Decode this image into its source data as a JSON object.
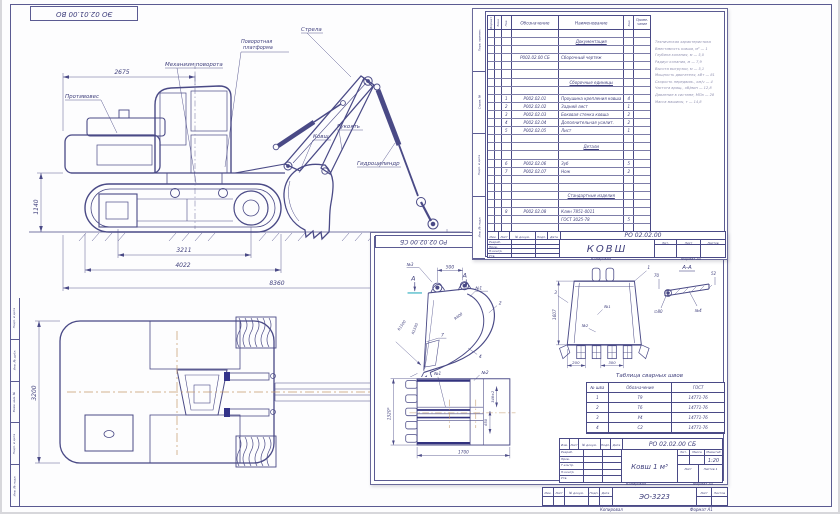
{
  "sheet": {
    "stamp_top": "ЭО 02.01.00 ВО",
    "model": "ЭО-3223",
    "footer_copy": "Копировал",
    "footer_format": "Формат А1",
    "cols": [
      "Изм.",
      "Лист",
      "№ докум.",
      "Подп.",
      "Дата"
    ],
    "sheet_lbl": "Лист",
    "sheets_lbl": "Листов",
    "margin_labels": [
      {
        "t": "Подп. и дата"
      },
      {
        "t": "Инв. № дубл."
      },
      {
        "t": "Взам. инв. №"
      },
      {
        "t": "Подп. и дата"
      },
      {
        "t": "Инв. № подл."
      }
    ]
  },
  "side_view": {
    "labels": {
      "counterweight": "Противовес",
      "swing": "Механизм поворота",
      "platform1": "Поворотная",
      "platform2": "платформа",
      "boom": "Стрела",
      "arm": "Рукоять",
      "bucket": "Ковш",
      "cylinder": "Гидроцилиндр"
    },
    "dims": {
      "top": "2675",
      "height": "1140",
      "d1": "3211",
      "d2": "4022",
      "d3": "8360"
    }
  },
  "plan_view": {
    "dims": {
      "width": "3200"
    }
  },
  "spec": {
    "margin_labels": [
      {
        "t": "Перв. примен."
      },
      {
        "t": "Справ. №"
      },
      {
        "t": "Подп. и дата"
      },
      {
        "t": "Инв. № подл."
      }
    ],
    "headers": {
      "fmt": "Формат",
      "zone": "Зона",
      "pos": "Поз.",
      "desig": "Обозначение",
      "name": "Наименование",
      "qty": "Кол.",
      "note1": "Приме-",
      "note2": "чание"
    },
    "rows": [
      {},
      {
        "name": "Документация",
        "cls": "sec"
      },
      {},
      {
        "desig": "Р002.02.00 СБ",
        "name": "Сборочный чертеж"
      },
      {},
      {},
      {
        "name": "Сборочные единицы",
        "cls": "sec"
      },
      {},
      {
        "pos": "1",
        "desig": "Р002.02.01",
        "name": "Проушина крепления ковша",
        "qty": "4"
      },
      {
        "pos": "2",
        "desig": "Р002.02.02",
        "name": "Задний лист",
        "qty": "1"
      },
      {
        "pos": "3",
        "desig": "Р002.02.03",
        "name": "Боковая стенка ковша",
        "qty": "2"
      },
      {
        "pos": "4",
        "desig": "Р002.02.04",
        "name": "Дополнительная усилит. стенка",
        "qty": "2"
      },
      {
        "pos": "5",
        "desig": "Р002.02.05",
        "name": "Лист",
        "qty": "1"
      },
      {},
      {
        "name": "Детали",
        "cls": "sec"
      },
      {},
      {
        "pos": "6",
        "desig": "Р002.02.06",
        "name": "Зуб",
        "qty": "5"
      },
      {
        "pos": "7",
        "desig": "Р002.02.07",
        "name": "Нож",
        "qty": "2"
      },
      {},
      {},
      {
        "name": "Стандартные изделия",
        "cls": "sec"
      },
      {},
      {
        "pos": "8",
        "desig": "Р002.02.08",
        "name": "Клин 7851-0011"
      },
      {
        "name": "ГОСТ 3025-78",
        "qty": "5"
      },
      {}
    ],
    "stamp": {
      "cols": [
        "Изм.",
        "Лист",
        "№ докум.",
        "Подп.",
        "Дата"
      ],
      "doc": "РО 02.02.00",
      "title": "КОВШ",
      "roles": [
        "Разраб.",
        "Пров.",
        "Н.контр.",
        "Утв."
      ],
      "lit": "Лит.",
      "sheet": "Лист",
      "sheets": "Листов"
    },
    "footer_copy": "Копировал",
    "footer_format": "Формат А4"
  },
  "tech": {
    "lines": [
      {
        "t": "Техническая характеристика"
      },
      {
        "t": "Вместимость ковша, м³ — 1"
      },
      {
        "t": "Глубина копания, м — 5,0"
      },
      {
        "t": "Радиус копания, м — 7,9"
      },
      {
        "t": "Высота выгрузки, м — 5,1"
      },
      {
        "t": "Мощность двигателя, кВт — 81"
      },
      {
        "t": "Скорость передвиж., км/ч — 4"
      },
      {
        "t": "Частота вращ., об/мин — 12,8"
      },
      {
        "t": "Давление в системе, МПа — 28"
      },
      {
        "t": "Масса машины, т — 14,8"
      }
    ]
  },
  "bucket": {
    "stamp_rot": "РО 02.02.00 СБ",
    "side": {
      "no3": "№3",
      "no1": "№1",
      "a_left": "А",
      "a_right": "А",
      "dim500": "500",
      "r1": "R1500",
      "r2": "R1590",
      "r3": "R600",
      "c2": "2",
      "c4": "4",
      "c6": "6",
      "c7": "7",
      "c8": "8"
    },
    "front": {
      "no1": "№1",
      "no2": "№2",
      "c1": "1",
      "c3": "3",
      "h": "1607",
      "d200": "200",
      "d300": "300"
    },
    "section": {
      "title": "А-А",
      "d70": "70",
      "d52": "52",
      "d80": "∅80",
      "no4": "№4"
    },
    "bottom": {
      "no1": "№1",
      "no2": "№2",
      "h": "1320*",
      "w": "1700",
      "d1": "348±2",
      "d2": "650"
    },
    "weld": {
      "caption": "Таблица сварных швов",
      "headers": [
        "№ шва",
        "Обозначение",
        "ГОСТ"
      ],
      "rows": [
        {
          "n": "1",
          "s": "Т9",
          "g": "14771-76"
        },
        {
          "n": "2",
          "s": "Т6",
          "g": "14771-76"
        },
        {
          "n": "3",
          "s": "У4",
          "g": "14771-76"
        },
        {
          "n": "4",
          "s": "С2",
          "g": "14771-76"
        }
      ]
    },
    "tb": {
      "doc": "РО 02.02.00 СБ",
      "title": "Ковш 1 м³",
      "scale": "1:20",
      "lit": "Лит.",
      "mass": "Масса",
      "scale_lbl": "Масштаб",
      "sheet": "Лист",
      "sheets": "Листов 1",
      "roles": [
        "Разраб.",
        "Пров.",
        "Т.контр.",
        "Н.контр.",
        "Утв."
      ],
      "cols": [
        "Изм.",
        "Лист",
        "№ докум.",
        "Подп.",
        "Дата"
      ],
      "copy": "Копировал",
      "format": "Формат А4"
    }
  }
}
